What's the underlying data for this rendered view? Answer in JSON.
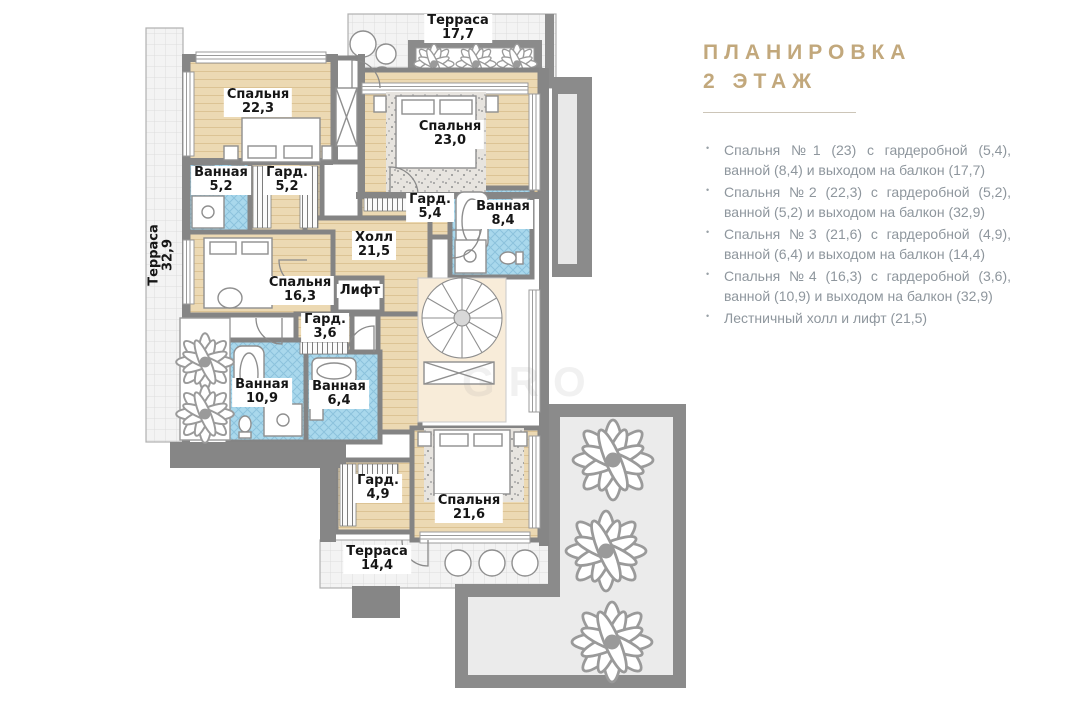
{
  "header": {
    "title_line1": "ПЛАНИРОВКА",
    "title_line2": "2 ЭТАЖ"
  },
  "legend": {
    "items": [
      "Спальня №1 (23) с гардеробной (5,4), ванной (8,4) и выходом на балкон (17,7)",
      "Спальня №2 (22,3) с гардеробной (5,2), ванной (5,2) и выходом на балкон (32,9)",
      "Спальня №3 (21,6) с гардеробной (4,9), ванной (6,4) и выходом на балкон (14,4)",
      "Спальня №4 (16,3) с гардеробной (3,6), ванной (10,9) и выходом на балкон (32,9)",
      "Лестничный холл и лифт (21,5)"
    ]
  },
  "floorplan": {
    "rooms": [
      {
        "name": "Терраса",
        "area": "17,7"
      },
      {
        "name": "Спальня",
        "area": "22,3"
      },
      {
        "name": "Ванная",
        "area": "5,2"
      },
      {
        "name": "Гард.",
        "area": "5,2"
      },
      {
        "name": "Спальня",
        "area": "23,0"
      },
      {
        "name": "Гард.",
        "area": "5,4"
      },
      {
        "name": "Ванная",
        "area": "8,4"
      },
      {
        "name": "Холл",
        "area": "21,5"
      },
      {
        "name": "Спальня",
        "area": "16,3"
      },
      {
        "name": "Лифт",
        "area": ""
      },
      {
        "name": "Гард.",
        "area": "3,6"
      },
      {
        "name": "Ванная",
        "area": "10,9"
      },
      {
        "name": "Ванная",
        "area": "6,4"
      },
      {
        "name": "Гард.",
        "area": "4,9"
      },
      {
        "name": "Спальня",
        "area": "21,6"
      },
      {
        "name": "Терраса",
        "area": "14,4"
      },
      {
        "name": "Терраса",
        "area": "32,9"
      }
    ],
    "watermark": "GRO"
  },
  "colors": {
    "accent_gold": "#c2a87c",
    "legend_gray": "#8e969d",
    "wall_gray": "#8b8b8b",
    "wood_floor": "#ecd9b3",
    "tile_blue": "#a9d8ec",
    "stairs_cream": "#f8ecd9"
  }
}
